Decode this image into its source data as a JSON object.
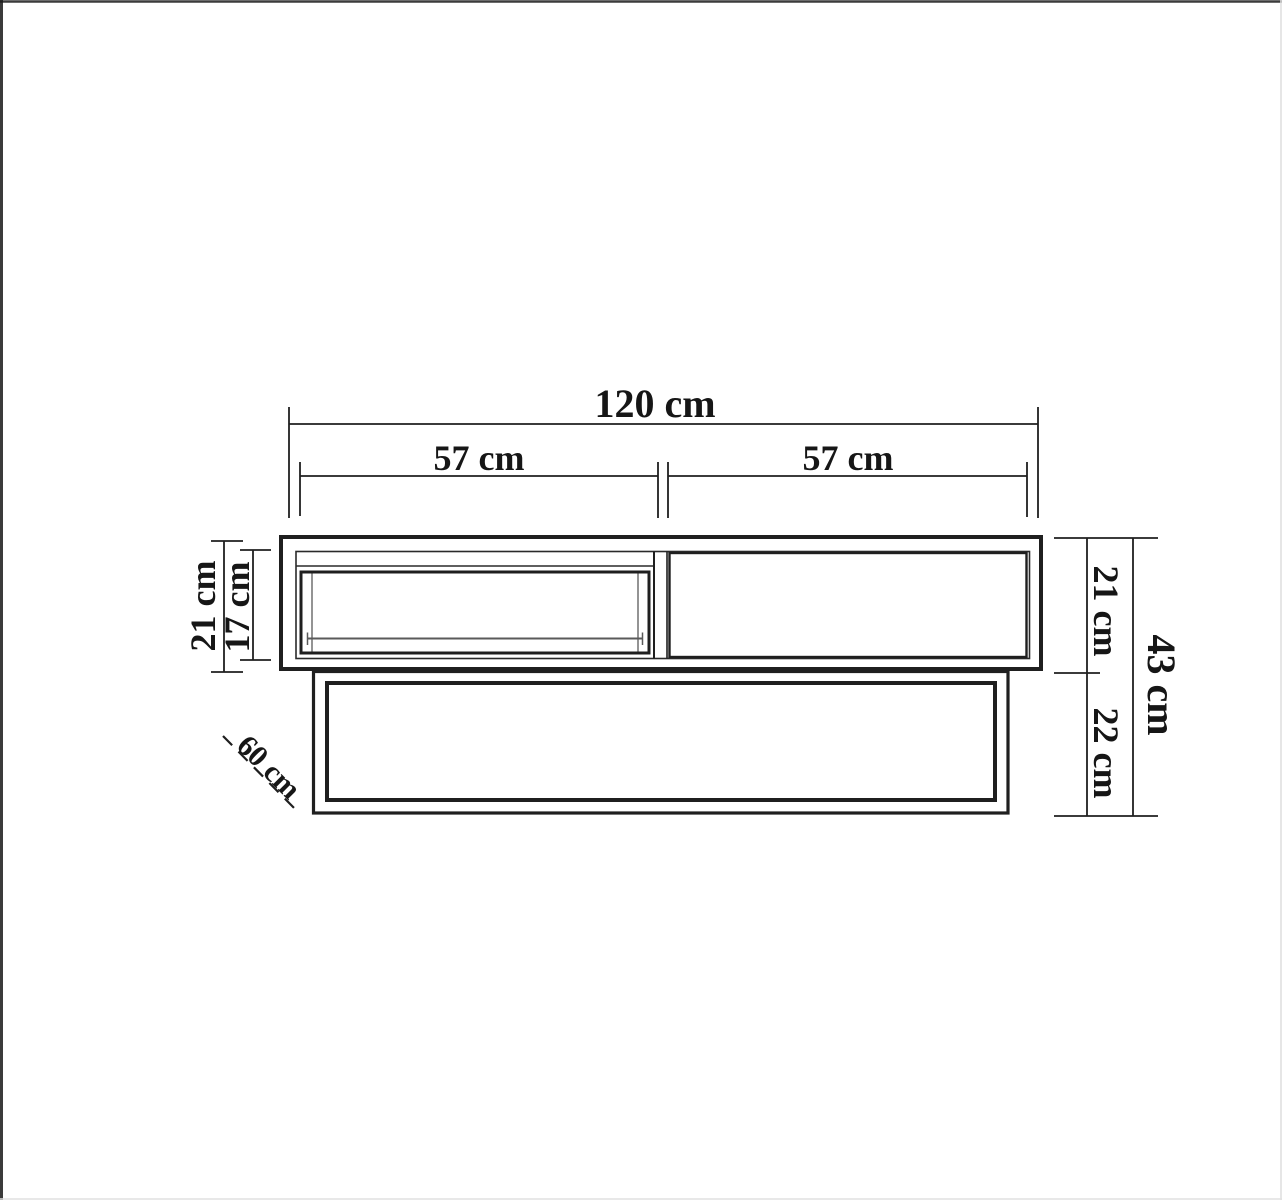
{
  "page": {
    "background": "#ffffff",
    "line_color": "#1f1f1f",
    "thin_line_color": "#5a5a5a",
    "description": "Technical dimension drawing of a two-level TV stand / coffee table, front elevation"
  },
  "labels": {
    "total_width": "120 cm",
    "left_compartment_width": "57 cm",
    "right_compartment_width": "57 cm",
    "top_unit_height": "21 cm",
    "drawer_front_height": "17 cm",
    "top_unit_height_right": "21 cm",
    "base_unit_height": "22 cm",
    "total_height": "43 cm",
    "depth": "60 cm"
  }
}
